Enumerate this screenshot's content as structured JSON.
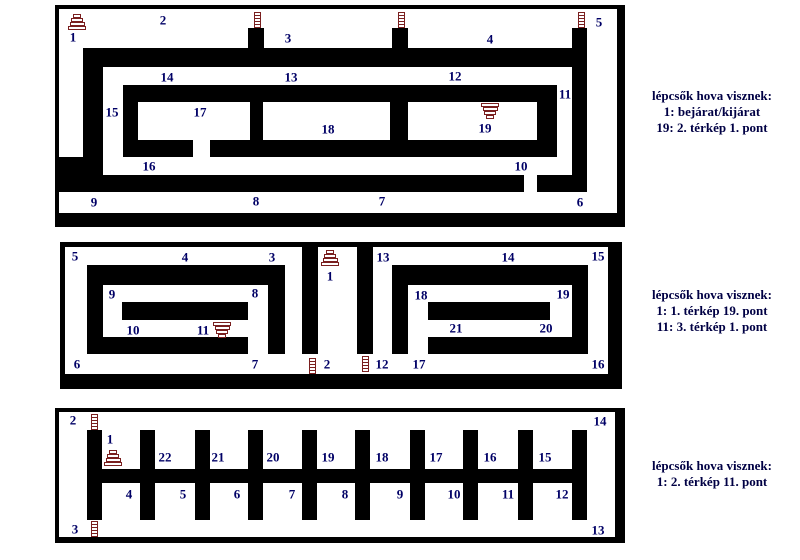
{
  "colors": {
    "background": "#ffffff",
    "wall": "#000000",
    "label": "#000066",
    "icon": "#7a1f1f",
    "legend_text": "#000044"
  },
  "legend": {
    "blocks": [
      {
        "map": "1",
        "lines": [
          "lépcsők hova visznek:",
          "1: bejárat/kijárat",
          "19: 2. térkép 1. pont"
        ]
      },
      {
        "map": "2",
        "lines": [
          "lépcsők hova visznek:",
          "1: 1. térkép 19. pont",
          "11: 3. térkép 1. pont"
        ]
      },
      {
        "map": "3",
        "lines": [
          "lépcsők hova visznek:",
          "1: 2. térkép 11. pont"
        ]
      }
    ]
  },
  "panels": [
    {
      "name": "map-1",
      "x": 55,
      "y": 5,
      "w": 570,
      "h": 222,
      "frame": [
        [
          0,
          0,
          570,
          4
        ],
        [
          0,
          0,
          4,
          222
        ],
        [
          562,
          0,
          8,
          222
        ],
        [
          0,
          208,
          570,
          14
        ]
      ],
      "walls": [
        [
          193,
          23,
          16,
          22
        ],
        [
          337,
          23,
          16,
          22
        ],
        [
          517,
          23,
          15,
          162
        ],
        [
          28,
          43,
          489,
          19
        ],
        [
          28,
          43,
          20,
          127
        ],
        [
          4,
          152,
          24,
          18
        ],
        [
          68,
          80,
          434,
          72
        ],
        [
          4,
          170,
          465,
          17
        ],
        [
          482,
          170,
          50,
          17
        ]
      ],
      "rooms": [
        [
          83,
          97,
          112,
          38
        ],
        [
          208,
          97,
          127,
          38
        ],
        [
          353,
          97,
          129,
          38
        ],
        [
          138,
          135,
          17,
          17
        ]
      ],
      "labels": [
        {
          "text": "1",
          "x": 18,
          "y": 32
        },
        {
          "text": "2",
          "x": 108,
          "y": 15
        },
        {
          "text": "3",
          "x": 233,
          "y": 33
        },
        {
          "text": "4",
          "x": 435,
          "y": 34
        },
        {
          "text": "5",
          "x": 544,
          "y": 17
        },
        {
          "text": "14",
          "x": 112,
          "y": 72
        },
        {
          "text": "13",
          "x": 236,
          "y": 72
        },
        {
          "text": "12",
          "x": 400,
          "y": 71
        },
        {
          "text": "11",
          "x": 510,
          "y": 89
        },
        {
          "text": "15",
          "x": 57,
          "y": 107
        },
        {
          "text": "17",
          "x": 145,
          "y": 107
        },
        {
          "text": "18",
          "x": 273,
          "y": 124
        },
        {
          "text": "19",
          "x": 430,
          "y": 123
        },
        {
          "text": "16",
          "x": 94,
          "y": 161
        },
        {
          "text": "10",
          "x": 466,
          "y": 161
        },
        {
          "text": "9",
          "x": 39,
          "y": 197
        },
        {
          "text": "8",
          "x": 201,
          "y": 196
        },
        {
          "text": "7",
          "x": 327,
          "y": 196
        },
        {
          "text": "6",
          "x": 525,
          "y": 197
        }
      ],
      "icons": [
        {
          "type": "stairs-up",
          "x": 13,
          "y": 9
        },
        {
          "type": "stairs-down",
          "x": 426,
          "y": 98
        },
        {
          "type": "ladder",
          "x": 199,
          "y": 7
        },
        {
          "type": "ladder",
          "x": 343,
          "y": 7
        },
        {
          "type": "ladder",
          "x": 523,
          "y": 7
        }
      ]
    },
    {
      "name": "map-2",
      "x": 60,
      "y": 242,
      "w": 562,
      "h": 147,
      "frame": [
        [
          0,
          0,
          562,
          5
        ],
        [
          0,
          0,
          5,
          147
        ],
        [
          548,
          0,
          14,
          147
        ],
        [
          0,
          132,
          562,
          15
        ]
      ],
      "walls": [
        [
          27,
          23,
          16,
          89
        ],
        [
          27,
          23,
          198,
          20
        ],
        [
          208,
          23,
          17,
          89
        ],
        [
          27,
          95,
          161,
          17
        ],
        [
          62,
          60,
          126,
          18
        ],
        [
          242,
          5,
          16,
          107
        ],
        [
          297,
          5,
          16,
          107
        ],
        [
          332,
          23,
          16,
          89
        ],
        [
          332,
          23,
          196,
          20
        ],
        [
          512,
          23,
          16,
          89
        ],
        [
          368,
          95,
          160,
          17
        ],
        [
          368,
          60,
          122,
          18
        ]
      ],
      "rooms": [],
      "labels": [
        {
          "text": "5",
          "x": 15,
          "y": 14
        },
        {
          "text": "4",
          "x": 125,
          "y": 15
        },
        {
          "text": "3",
          "x": 212,
          "y": 15
        },
        {
          "text": "1",
          "x": 270,
          "y": 34
        },
        {
          "text": "13",
          "x": 323,
          "y": 15
        },
        {
          "text": "14",
          "x": 448,
          "y": 15
        },
        {
          "text": "15",
          "x": 538,
          "y": 14
        },
        {
          "text": "9",
          "x": 52,
          "y": 52
        },
        {
          "text": "8",
          "x": 195,
          "y": 51
        },
        {
          "text": "18",
          "x": 361,
          "y": 53
        },
        {
          "text": "19",
          "x": 503,
          "y": 52
        },
        {
          "text": "10",
          "x": 73,
          "y": 88
        },
        {
          "text": "11",
          "x": 143,
          "y": 88
        },
        {
          "text": "21",
          "x": 396,
          "y": 86
        },
        {
          "text": "20",
          "x": 486,
          "y": 86
        },
        {
          "text": "6",
          "x": 17,
          "y": 122
        },
        {
          "text": "7",
          "x": 195,
          "y": 122
        },
        {
          "text": "2",
          "x": 267,
          "y": 122
        },
        {
          "text": "12",
          "x": 322,
          "y": 122
        },
        {
          "text": "17",
          "x": 359,
          "y": 122
        },
        {
          "text": "16",
          "x": 538,
          "y": 122
        }
      ],
      "icons": [
        {
          "type": "stairs-up",
          "x": 261,
          "y": 8
        },
        {
          "type": "stairs-down",
          "x": 153,
          "y": 80
        },
        {
          "type": "ladder",
          "x": 249,
          "y": 116
        },
        {
          "type": "ladder",
          "x": 302,
          "y": 114
        }
      ]
    },
    {
      "name": "map-3",
      "x": 55,
      "y": 408,
      "w": 570,
      "h": 135,
      "frame": [
        [
          0,
          0,
          570,
          4
        ],
        [
          0,
          0,
          4,
          135
        ],
        [
          560,
          0,
          10,
          135
        ],
        [
          0,
          129,
          570,
          6
        ]
      ],
      "walls": [
        [
          32,
          22,
          15,
          90
        ],
        [
          517,
          22,
          15,
          90
        ],
        [
          32,
          61,
          500,
          14
        ],
        [
          85,
          22,
          15,
          39
        ],
        [
          140,
          22,
          15,
          39
        ],
        [
          193,
          22,
          15,
          39
        ],
        [
          247,
          22,
          15,
          39
        ],
        [
          300,
          22,
          15,
          39
        ],
        [
          355,
          22,
          15,
          39
        ],
        [
          408,
          22,
          15,
          39
        ],
        [
          463,
          22,
          15,
          39
        ],
        [
          85,
          75,
          15,
          37
        ],
        [
          140,
          75,
          15,
          37
        ],
        [
          193,
          75,
          15,
          37
        ],
        [
          247,
          75,
          15,
          37
        ],
        [
          300,
          75,
          15,
          37
        ],
        [
          355,
          75,
          15,
          37
        ],
        [
          408,
          75,
          15,
          37
        ],
        [
          463,
          75,
          15,
          37
        ]
      ],
      "rooms": [],
      "labels": [
        {
          "text": "2",
          "x": 18,
          "y": 12
        },
        {
          "text": "14",
          "x": 545,
          "y": 13
        },
        {
          "text": "3",
          "x": 20,
          "y": 121
        },
        {
          "text": "13",
          "x": 543,
          "y": 122
        },
        {
          "text": "1",
          "x": 55,
          "y": 31
        },
        {
          "text": "22",
          "x": 110,
          "y": 49
        },
        {
          "text": "21",
          "x": 163,
          "y": 49
        },
        {
          "text": "20",
          "x": 218,
          "y": 49
        },
        {
          "text": "19",
          "x": 273,
          "y": 49
        },
        {
          "text": "18",
          "x": 327,
          "y": 49
        },
        {
          "text": "17",
          "x": 381,
          "y": 49
        },
        {
          "text": "16",
          "x": 435,
          "y": 49
        },
        {
          "text": "15",
          "x": 490,
          "y": 49
        },
        {
          "text": "4",
          "x": 74,
          "y": 86
        },
        {
          "text": "5",
          "x": 128,
          "y": 86
        },
        {
          "text": "6",
          "x": 182,
          "y": 86
        },
        {
          "text": "7",
          "x": 237,
          "y": 86
        },
        {
          "text": "8",
          "x": 290,
          "y": 86
        },
        {
          "text": "9",
          "x": 345,
          "y": 86
        },
        {
          "text": "10",
          "x": 399,
          "y": 86
        },
        {
          "text": "11",
          "x": 453,
          "y": 86
        },
        {
          "text": "12",
          "x": 507,
          "y": 86
        }
      ],
      "icons": [
        {
          "type": "stairs-up",
          "x": 49,
          "y": 42
        },
        {
          "type": "ladder",
          "x": 36,
          "y": 6
        },
        {
          "type": "ladder",
          "x": 36,
          "y": 113
        }
      ]
    }
  ]
}
